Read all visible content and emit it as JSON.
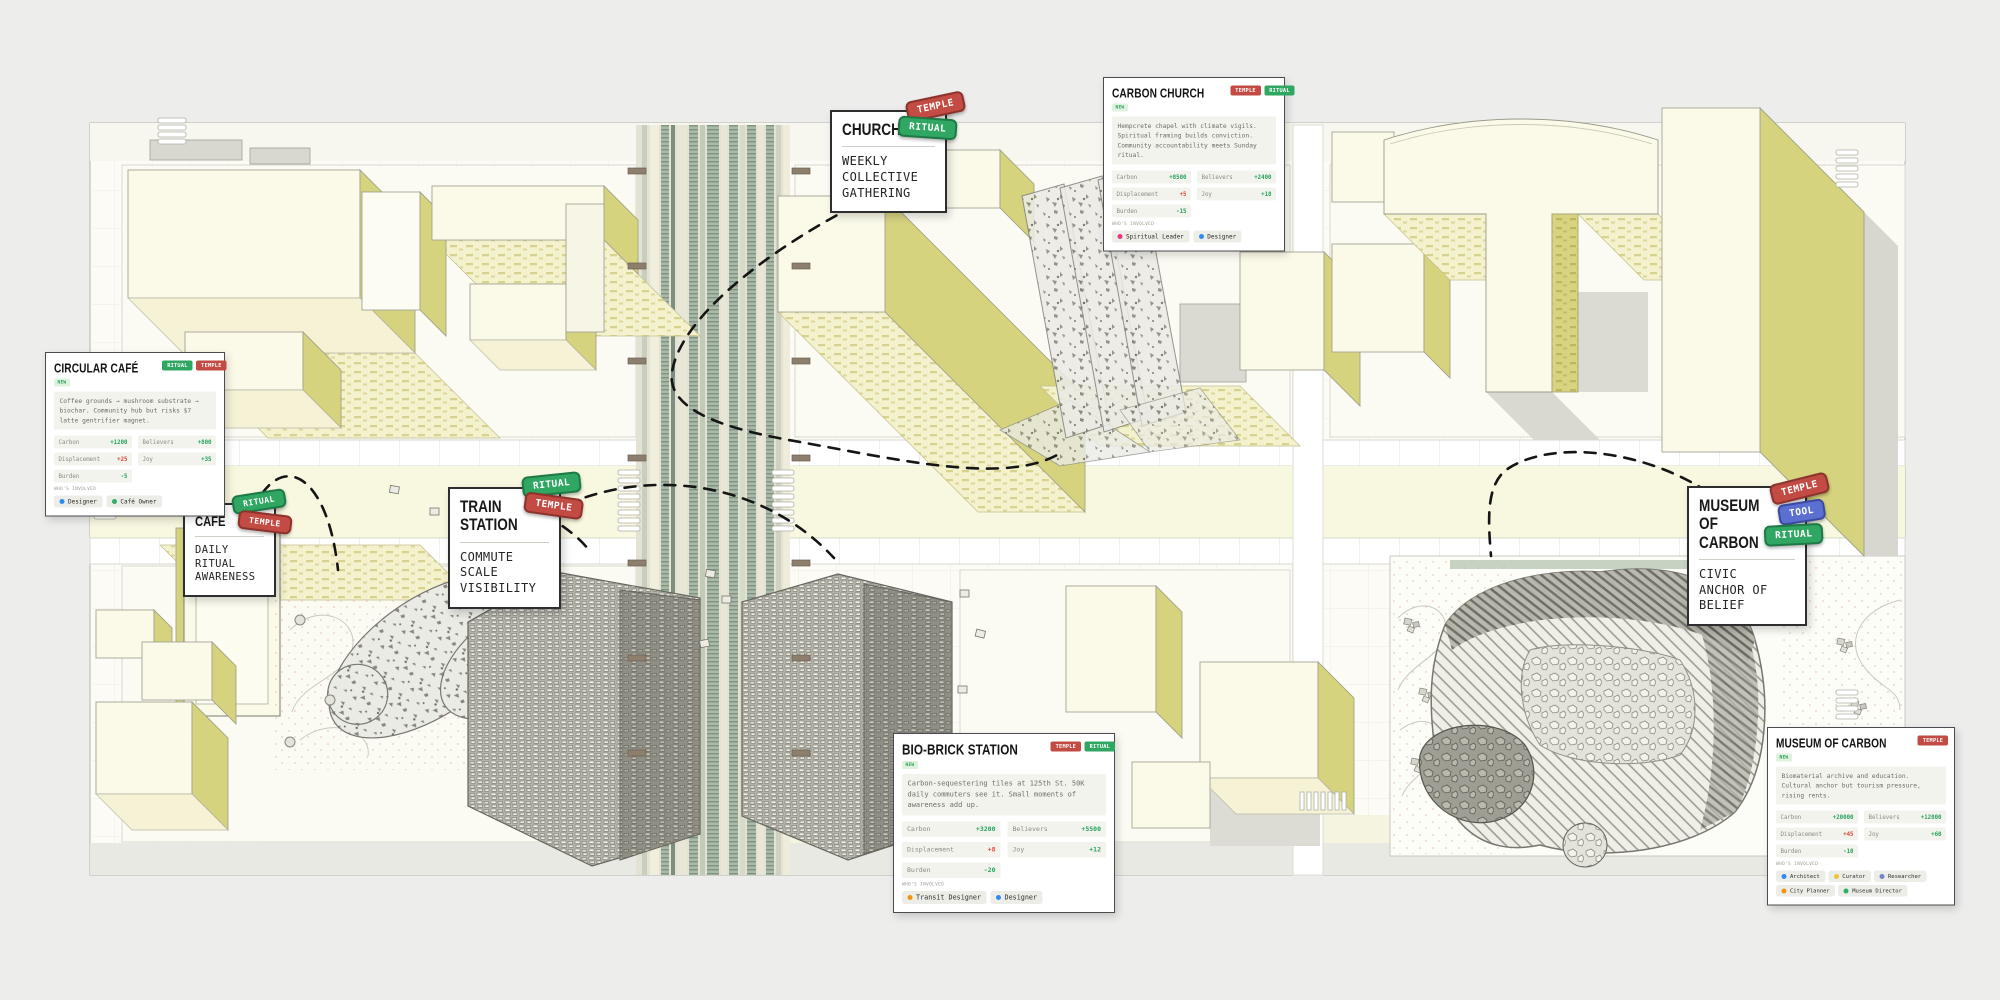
{
  "cards": {
    "circular_cafe": {
      "title": "CIRCULAR CAFÉ",
      "badge": "NEW",
      "tags": [
        {
          "label": "RITUAL",
          "bg": "#2fa661",
          "border": "#1e7a45"
        },
        {
          "label": "TEMPLE",
          "bg": "#c24b43",
          "border": "#8e322d"
        }
      ],
      "description": "Coffee grounds → mushroom substrate → biochar. Community hub but risks $7 latte gentrifier magnet.",
      "stats": [
        {
          "label": "Carbon",
          "value": "+1200",
          "color": "#27a25c"
        },
        {
          "label": "Believers",
          "value": "+800",
          "color": "#27a25c"
        },
        {
          "label": "Displacement",
          "value": "+25",
          "color": "#df4a3a"
        },
        {
          "label": "Joy",
          "value": "+35",
          "color": "#27a25c"
        },
        {
          "label": "Burden",
          "value": "-5",
          "color": "#27a25c"
        }
      ],
      "involved_label": "WHO'S INVOLVED",
      "people": [
        {
          "name": "Designer",
          "dot": "#2d8cf0"
        },
        {
          "name": "Café Owner",
          "dot": "#2fae68"
        }
      ]
    },
    "carbon_church": {
      "title": "CARBON CHURCH",
      "badge": "NEW",
      "tags": [
        {
          "label": "TEMPLE",
          "bg": "#c24b43",
          "border": "#8e322d"
        },
        {
          "label": "RITUAL",
          "bg": "#2fa661",
          "border": "#1e7a45"
        }
      ],
      "description": "Hempcrete chapel with climate vigils. Spiritual framing builds conviction. Community accountability meets Sunday ritual.",
      "stats": [
        {
          "label": "Carbon",
          "value": "+8500",
          "color": "#27a25c"
        },
        {
          "label": "Believers",
          "value": "+2400",
          "color": "#27a25c"
        },
        {
          "label": "Displacement",
          "value": "+5",
          "color": "#df4a3a"
        },
        {
          "label": "Joy",
          "value": "+18",
          "color": "#27a25c"
        },
        {
          "label": "Burden",
          "value": "-15",
          "color": "#27a25c"
        }
      ],
      "involved_label": "WHO'S INVOLVED",
      "people": [
        {
          "name": "Spiritual Leader",
          "dot": "#e8357f"
        },
        {
          "name": "Designer",
          "dot": "#2d8cf0"
        }
      ]
    },
    "bio_brick": {
      "title": "BIO-BRICK STATION",
      "badge": "NEW",
      "tags": [
        {
          "label": "TEMPLE",
          "bg": "#c24b43",
          "border": "#8e322d"
        },
        {
          "label": "RITUAL",
          "bg": "#2fa661",
          "border": "#1e7a45"
        }
      ],
      "description": "Carbon-sequestering tiles at 125th St. 50K daily commuters see it. Small moments of awareness add up.",
      "stats": [
        {
          "label": "Carbon",
          "value": "+3200",
          "color": "#27a25c"
        },
        {
          "label": "Believers",
          "value": "+5500",
          "color": "#27a25c"
        },
        {
          "label": "Displacement",
          "value": "+8",
          "color": "#df4a3a"
        },
        {
          "label": "Joy",
          "value": "+12",
          "color": "#27a25c"
        },
        {
          "label": "Burden",
          "value": "-20",
          "color": "#27a25c"
        }
      ],
      "involved_label": "WHO'S INVOLVED",
      "people": [
        {
          "name": "Transit Designer",
          "dot": "#f5930f"
        },
        {
          "name": "Designer",
          "dot": "#2d8cf0"
        }
      ]
    },
    "museum": {
      "title": "MUSEUM OF CARBON",
      "badge": "NEW",
      "tags": [
        {
          "label": "TEMPLE",
          "bg": "#c24b43",
          "border": "#8e322d"
        }
      ],
      "description": "Biomaterial archive and education. Cultural anchor but tourism pressure, rising rents.",
      "stats": [
        {
          "label": "Carbon",
          "value": "+20000",
          "color": "#27a25c"
        },
        {
          "label": "Believers",
          "value": "+12000",
          "color": "#27a25c"
        },
        {
          "label": "Displacement",
          "value": "+45",
          "color": "#df4a3a"
        },
        {
          "label": "Joy",
          "value": "+60",
          "color": "#27a25c"
        },
        {
          "label": "Burden",
          "value": "-10",
          "color": "#27a25c"
        }
      ],
      "involved_label": "WHO'S INVOLVED",
      "people": [
        {
          "name": "Architect",
          "dot": "#2d8cf0"
        },
        {
          "name": "Curator",
          "dot": "#f0c33c"
        },
        {
          "name": "Researcher",
          "dot": "#7286c9"
        },
        {
          "name": "City Planner",
          "dot": "#f5930f"
        },
        {
          "name": "Museum Director",
          "dot": "#2fae68"
        }
      ]
    }
  },
  "labels": {
    "church": {
      "title": "CHURCH",
      "body": "WEEKLY\nCOLLECTIVE\nGATHERING",
      "tags": [
        {
          "label": "TEMPLE",
          "bg": "#c24b43",
          "border": "#8e322d"
        },
        {
          "label": "RITUAL",
          "bg": "#2fa661",
          "border": "#1e7a45"
        }
      ]
    },
    "cafe": {
      "title": "CAFE",
      "body": "DAILY\nRITUAL\nAWARENESS",
      "tags": [
        {
          "label": "RITUAL",
          "bg": "#2fa661",
          "border": "#1e7a45"
        },
        {
          "label": "TEMPLE",
          "bg": "#c24b43",
          "border": "#8e322d"
        }
      ]
    },
    "train": {
      "title": "TRAIN\nSTATION",
      "body": "COMMUTE\nSCALE\nVISIBILITY",
      "tags": [
        {
          "label": "RITUAL",
          "bg": "#2fa661",
          "border": "#1e7a45"
        },
        {
          "label": "TEMPLE",
          "bg": "#c24b43",
          "border": "#8e322d"
        }
      ]
    },
    "museum_label": {
      "title": "MUSEUM OF\nCARBON",
      "body": "CIVIC\nANCHOR OF\nBELIEF",
      "tags": [
        {
          "label": "TEMPLE",
          "bg": "#c24b43",
          "border": "#8e322d"
        },
        {
          "label": "TOOL",
          "bg": "#5b6fd1",
          "border": "#3a4aa0"
        },
        {
          "label": "RITUAL",
          "bg": "#2fa661",
          "border": "#1e7a45"
        }
      ]
    }
  }
}
